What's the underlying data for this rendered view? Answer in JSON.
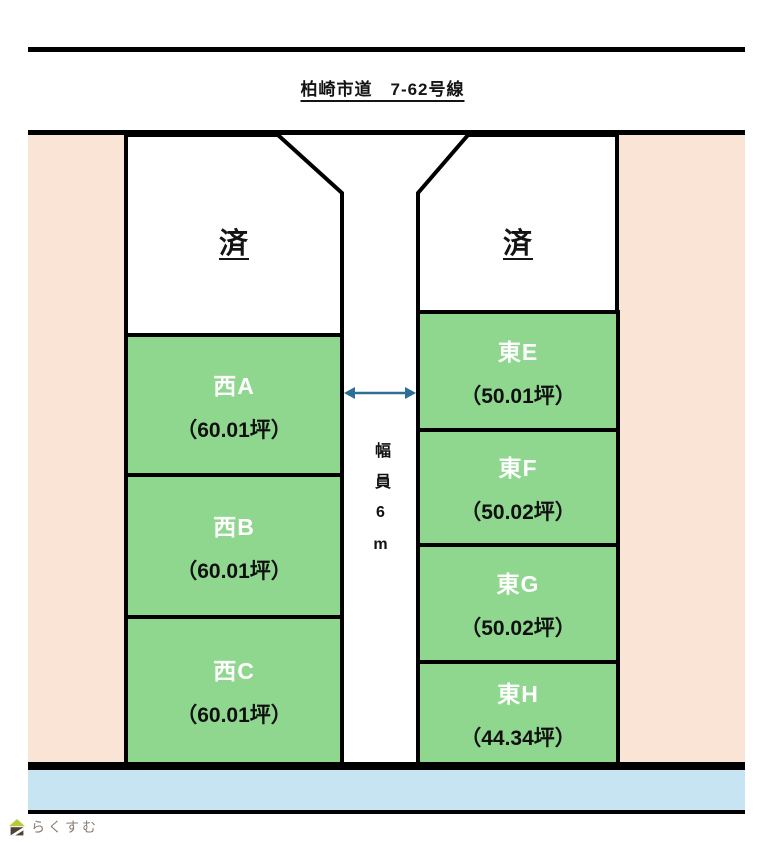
{
  "header": {
    "road_name": "柏崎市道　7-62号線"
  },
  "west_column": {
    "sold_label": "済",
    "plots": [
      {
        "name": "西A",
        "area": "（60.01坪）"
      },
      {
        "name": "西B",
        "area": "（60.01坪）"
      },
      {
        "name": "西C",
        "area": "（60.01坪）"
      }
    ]
  },
  "east_column": {
    "sold_label": "済",
    "plots": [
      {
        "name": "東E",
        "area": "（50.01坪）"
      },
      {
        "name": "東F",
        "area": "（50.02坪）"
      },
      {
        "name": "東G",
        "area": "（50.02坪）"
      },
      {
        "name": "東H",
        "area": "（44.34坪）"
      }
    ]
  },
  "road": {
    "width_label": "幅員6m"
  },
  "footer": {
    "logo_text": "らくすむ"
  },
  "colors": {
    "plot_green": "#8FD78F",
    "margin_salmon": "#FAE4D5",
    "strip_blue": "#C6E4F2",
    "arrow_blue": "#2D6E96",
    "border_black": "#000000"
  }
}
